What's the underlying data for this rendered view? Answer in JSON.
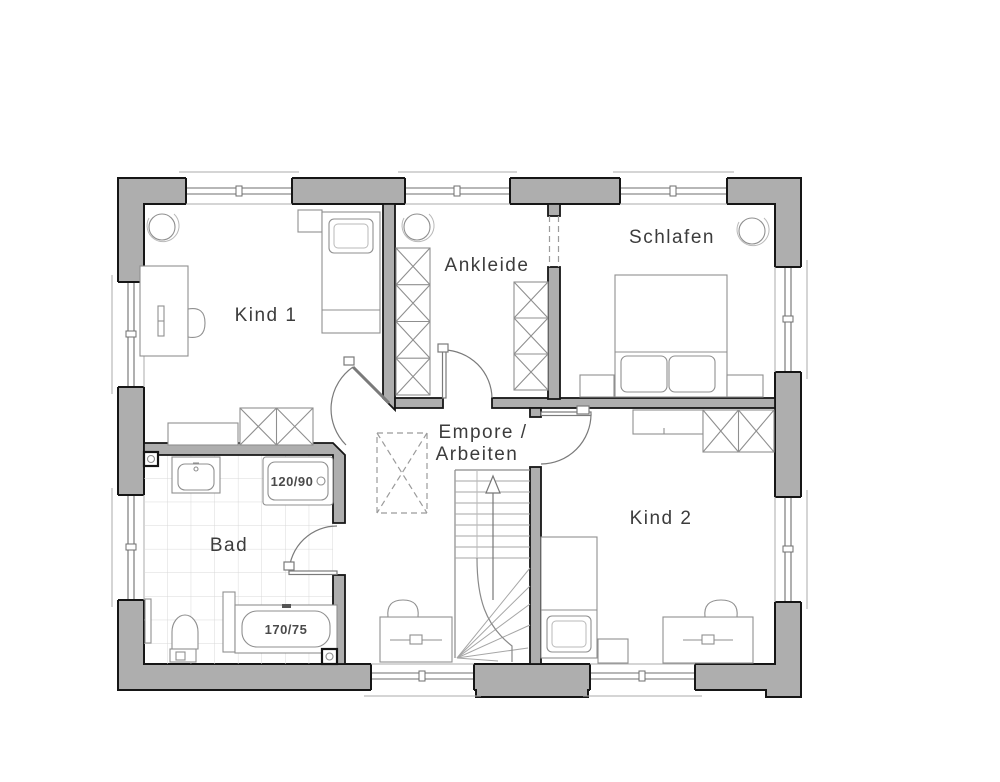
{
  "colors": {
    "background": "#ffffff",
    "wall_fill": "#aeaeae",
    "wall_stroke": "#161616",
    "furniture": "#8f8f8f",
    "stair": "#a6a6a6",
    "tile": "#d8d8d8",
    "dash": "#9b9b9b",
    "door": "#7a7a7a",
    "text_color": "#3c3c3c"
  },
  "rooms": {
    "kind1": {
      "label": "Kind 1"
    },
    "ankleide": {
      "label": "Ankleide"
    },
    "schlafen": {
      "label": "Schlafen"
    },
    "empore": {
      "label_line1": "Empore /",
      "label_line2": "Arbeiten"
    },
    "bad": {
      "label": "Bad"
    },
    "kind2": {
      "label": "Kind 2"
    }
  },
  "fixtures": {
    "shower_dimension": "120/90",
    "bathtub_dimension": "170/75"
  }
}
